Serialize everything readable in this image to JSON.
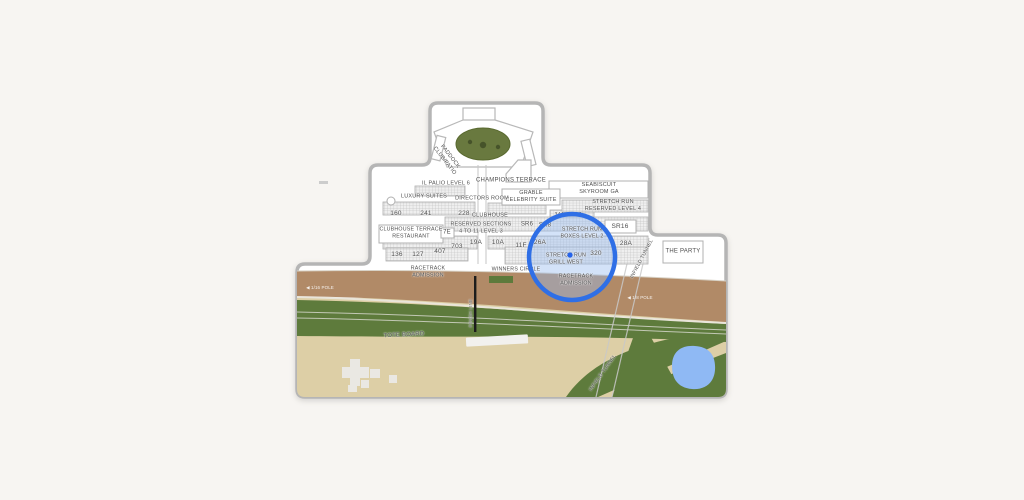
{
  "sections": {
    "paddock_club": "PADDOCK\nCLUB/PATIO",
    "champions_terrace": "CHAMPIONS TERRACE",
    "il_palio": "IL PALIO LEVEL 6",
    "seabiscuit_skyroom": "SEABISCUIT\nSKYROOM GA",
    "grable_celebrity": "GRABLE\nCELEBRITY SUITE",
    "luxury_suites": "LUXURY SUITES",
    "directors_room": "DIRECTORS ROOM",
    "stretch_run_reserved": "STRETCH RUN\nRESERVED LEVEL 4",
    "sec_160": "160",
    "sec_241": "241",
    "sec_228": "228",
    "clubhouse": "CLUBHOUSE",
    "sec_34j": "34J",
    "sec_41j": "41J",
    "clubhouse_terrace": "CLUBHOUSE TERRACE\nRESTAURANT",
    "sec_7e": "7E",
    "reserved_sections": "RESERVED SECTIONS\n4 TO 11 LEVEL 3",
    "sr6": "SR6",
    "sr8": "SR8",
    "sr16": "SR16",
    "stretch_run_boxes": "STRETCH RUN\nBOXES LEVEL 2",
    "sec_703": "703",
    "sec_19a": "19A",
    "sec_10a": "10A",
    "sec_11f": "11F",
    "sec_26a": "26A",
    "sec_28a": "28A",
    "sec_136": "136",
    "sec_127": "127",
    "sec_407": "407",
    "stretch_run_grill": "STRETCH RUN\nGRILL WEST",
    "sec_320": "320",
    "racetrack_admission": "RACETRACK\nADMISSION",
    "winners_circle": "WINNERS CIRCLE",
    "the_party": "THE PARTY"
  },
  "landmarks": {
    "infield_tunnel": "INFIELD TUNNEL",
    "finish_line": "FINISH LINE",
    "tote_board": "TOTE BOARD",
    "pole_left": "◀ 1/16 POLE",
    "pole_right": "◀ 1/8 POLE"
  },
  "colors": {
    "page_bg": "#f7f5f2",
    "map_border": "#b5b5b5",
    "label_text": "#4e4e4e",
    "dirt": "#b18a67",
    "turf": "#5e7b3c",
    "infield": "#ddcfa6",
    "pond": "#8fb9f4",
    "paddock_green": "#69793f",
    "winners_green": "#5d7a3b",
    "highlight_ring": "#2f6fe6",
    "highlight_fill": "rgba(150,186,238,0.42)",
    "pin": "#2563eb"
  }
}
